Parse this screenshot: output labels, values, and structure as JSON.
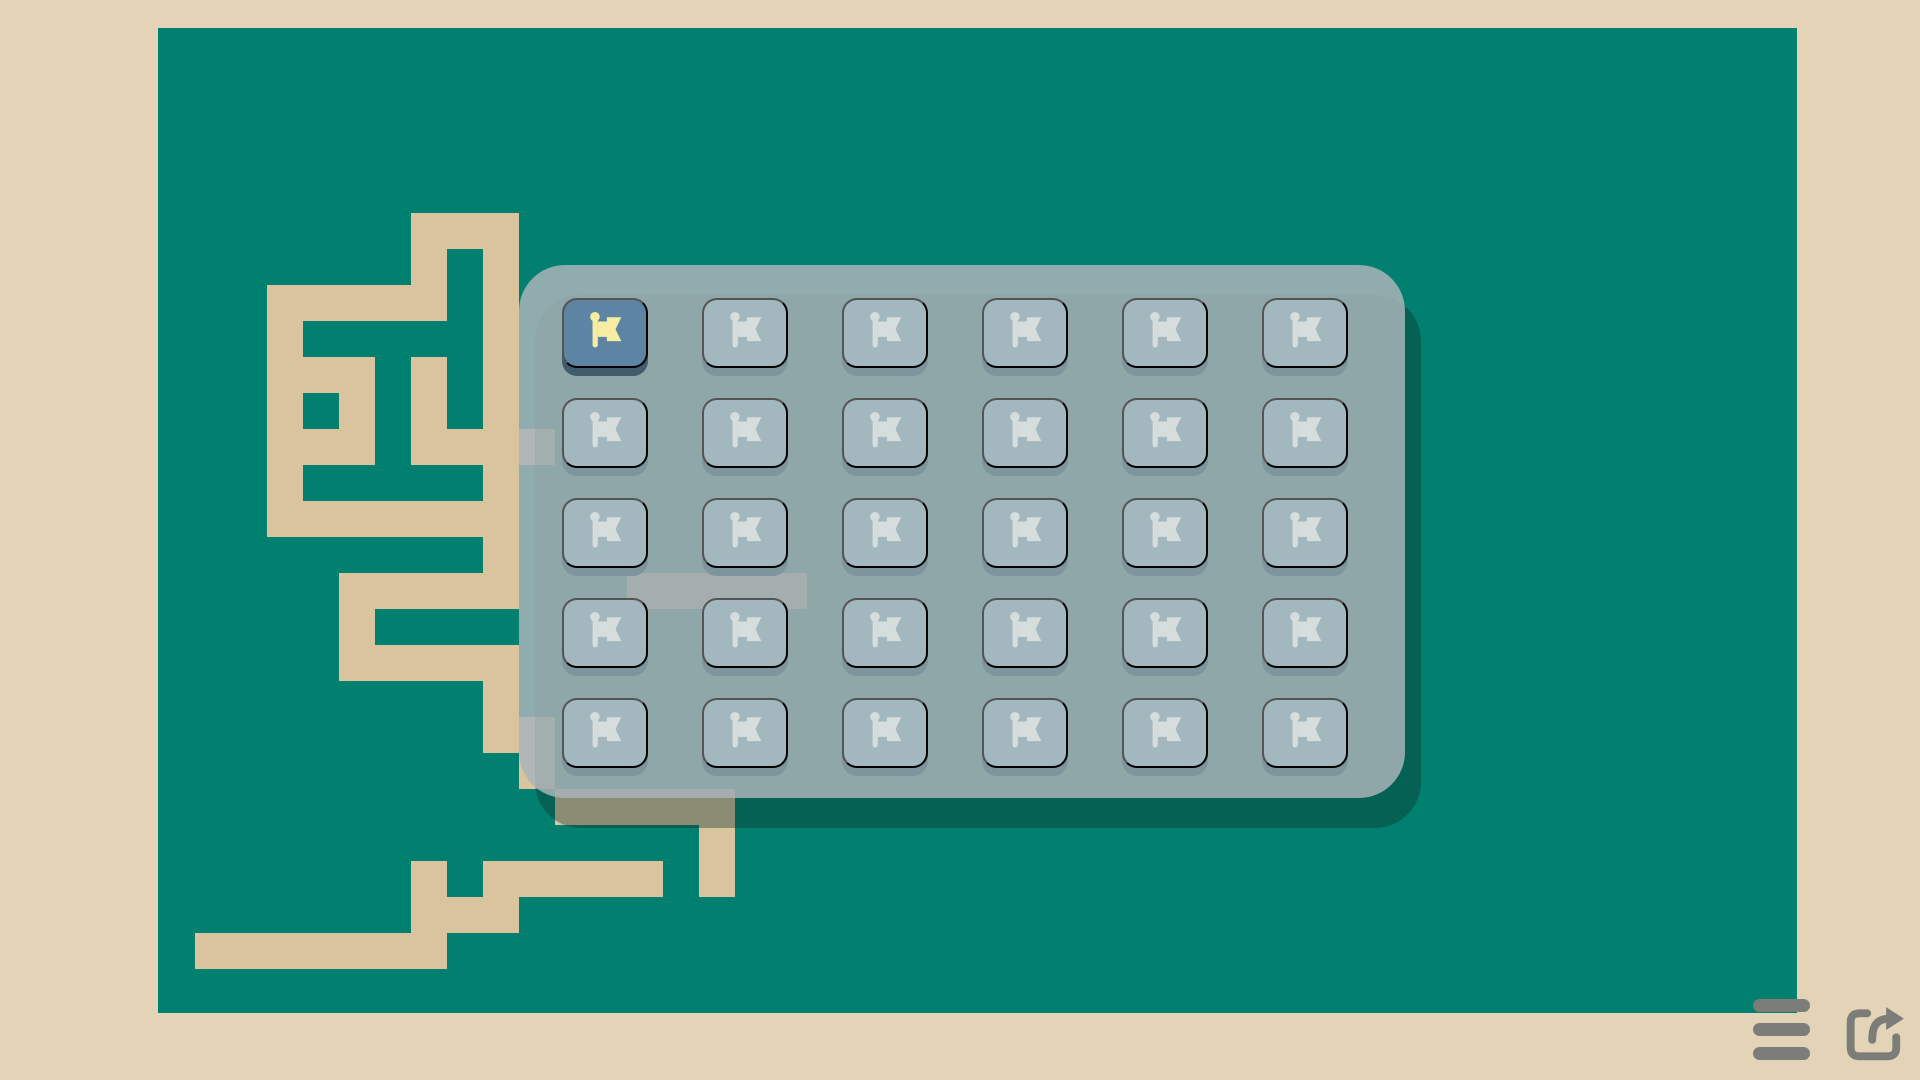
{
  "app": {
    "title": "pixel-maze-level-select"
  },
  "colors": {
    "page_bg": "#e3d4b7",
    "board_bg": "#01806f",
    "path_tan": "#d9c49e",
    "panel_fill": "rgba(169,180,186,0.85)",
    "panel_shadow": "rgba(16,48,46,0.38)",
    "button_face": "#a2b7be",
    "button_depth": "#7e959d",
    "button_flag": "#d6dddd",
    "selected_face": "#5d85a3",
    "selected_depth": "#415c6b",
    "selected_flag": "#f6eda3",
    "icon_gray": "#7c7c78"
  },
  "board": {
    "x": 158,
    "y": 28,
    "w": 1639,
    "h": 985
  },
  "maze": {
    "unit": 36,
    "origin_x": 159,
    "origin_y": 33,
    "runs": [
      [
        5,
        7,
        9
      ],
      [
        6,
        7,
        7
      ],
      [
        6,
        9,
        9
      ],
      [
        7,
        3,
        7
      ],
      [
        7,
        9,
        9
      ],
      [
        8,
        3,
        3
      ],
      [
        8,
        9,
        9
      ],
      [
        9,
        3,
        5
      ],
      [
        9,
        7,
        7
      ],
      [
        9,
        9,
        9
      ],
      [
        10,
        3,
        3
      ],
      [
        10,
        5,
        5
      ],
      [
        10,
        7,
        7
      ],
      [
        10,
        9,
        9
      ],
      [
        11,
        3,
        5
      ],
      [
        11,
        7,
        10
      ],
      [
        12,
        3,
        3
      ],
      [
        12,
        9,
        9
      ],
      [
        13,
        3,
        9
      ],
      [
        14,
        9,
        9
      ],
      [
        15,
        5,
        9
      ],
      [
        15,
        13,
        17
      ],
      [
        16,
        5,
        5
      ],
      [
        17,
        5,
        9
      ],
      [
        18,
        9,
        9
      ],
      [
        19,
        9,
        10
      ],
      [
        20,
        10,
        10
      ],
      [
        21,
        11,
        15
      ],
      [
        22,
        15,
        15
      ],
      [
        23,
        7,
        7
      ],
      [
        23,
        9,
        13
      ],
      [
        23,
        15,
        15
      ],
      [
        24,
        7,
        9
      ],
      [
        25,
        1,
        7
      ]
    ]
  },
  "level_panel": {
    "x": 519,
    "y": 265,
    "w": 886,
    "h": 533,
    "radius": 46,
    "shadow_dx": 16,
    "shadow_dy": 30,
    "grid": {
      "rows": 5,
      "cols": 6,
      "cell_w": 86,
      "cell_h": 70,
      "depth": 8,
      "first_x": 562,
      "first_y": 298,
      "step_x": 140,
      "step_y": 100
    },
    "flag_icon": "flag-icon",
    "levels": [
      {
        "id": 1,
        "selected": true
      },
      {
        "id": 2,
        "selected": false
      },
      {
        "id": 3,
        "selected": false
      },
      {
        "id": 4,
        "selected": false
      },
      {
        "id": 5,
        "selected": false
      },
      {
        "id": 6,
        "selected": false
      },
      {
        "id": 7,
        "selected": false
      },
      {
        "id": 8,
        "selected": false
      },
      {
        "id": 9,
        "selected": false
      },
      {
        "id": 10,
        "selected": false
      },
      {
        "id": 11,
        "selected": false
      },
      {
        "id": 12,
        "selected": false
      },
      {
        "id": 13,
        "selected": false
      },
      {
        "id": 14,
        "selected": false
      },
      {
        "id": 15,
        "selected": false
      },
      {
        "id": 16,
        "selected": false
      },
      {
        "id": 17,
        "selected": false
      },
      {
        "id": 18,
        "selected": false
      },
      {
        "id": 19,
        "selected": false
      },
      {
        "id": 20,
        "selected": false
      },
      {
        "id": 21,
        "selected": false
      },
      {
        "id": 22,
        "selected": false
      },
      {
        "id": 23,
        "selected": false
      },
      {
        "id": 24,
        "selected": false
      },
      {
        "id": 25,
        "selected": false
      },
      {
        "id": 26,
        "selected": false
      },
      {
        "id": 27,
        "selected": false
      },
      {
        "id": 28,
        "selected": false
      },
      {
        "id": 29,
        "selected": false
      },
      {
        "id": 30,
        "selected": false
      }
    ]
  },
  "footer": {
    "menu": {
      "icon": "menu-icon",
      "x": 1753,
      "y": 999,
      "bar_w": 57,
      "bar_h": 13,
      "bar_step": 24
    },
    "share": {
      "icon": "share-icon",
      "x": 1838,
      "y": 993,
      "size": 76
    }
  }
}
